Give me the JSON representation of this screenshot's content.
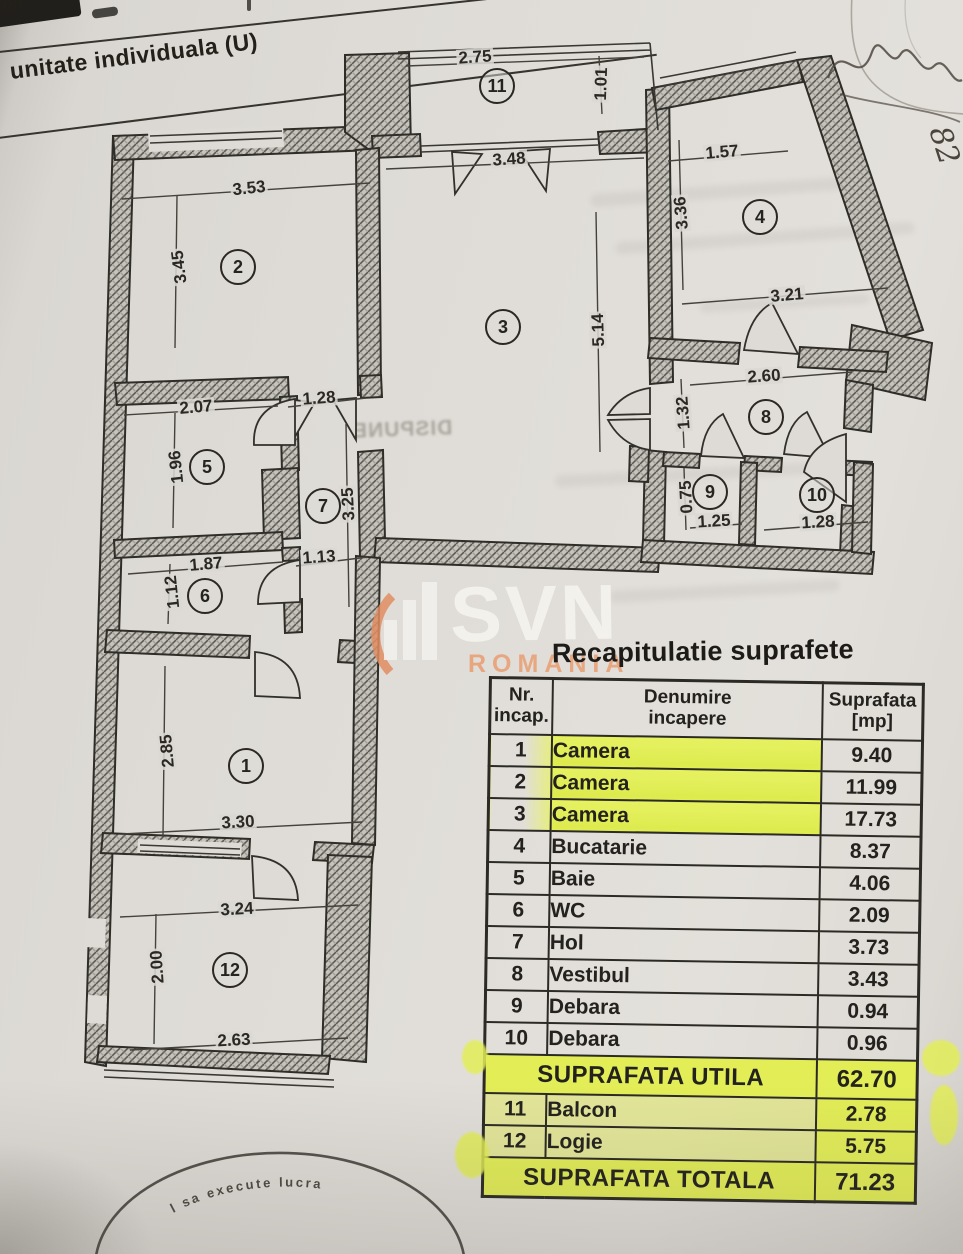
{
  "page": {
    "top_left_fragment": "tea",
    "top_left_title": "unitate individuala (U)",
    "handwritten_note": "82",
    "stamp_arc_text": "l sa execute lucra",
    "bleed_text": "DISPUNE"
  },
  "watermark": {
    "brand": "SVN",
    "region": "ROMANIA",
    "accent_orange": "#e08d62",
    "letter_color": "#f3f1ed"
  },
  "plan": {
    "rooms": [
      {
        "num": "1"
      },
      {
        "num": "2"
      },
      {
        "num": "3"
      },
      {
        "num": "4"
      },
      {
        "num": "5"
      },
      {
        "num": "6"
      },
      {
        "num": "7"
      },
      {
        "num": "8"
      },
      {
        "num": "9"
      },
      {
        "num": "10"
      },
      {
        "num": "11"
      },
      {
        "num": "12"
      }
    ],
    "dimensions": [
      {
        "value": "2.75",
        "orient": "h"
      },
      {
        "value": "1.01",
        "orient": "v"
      },
      {
        "value": "3.48",
        "orient": "h"
      },
      {
        "value": "1.57",
        "orient": "h"
      },
      {
        "value": "3.36",
        "orient": "v"
      },
      {
        "value": "3.53",
        "orient": "h"
      },
      {
        "value": "3.45",
        "orient": "v"
      },
      {
        "value": "3.21",
        "orient": "h"
      },
      {
        "value": "5.14",
        "orient": "v"
      },
      {
        "value": "2.60",
        "orient": "h"
      },
      {
        "value": "1.32",
        "orient": "v"
      },
      {
        "value": "2.07",
        "orient": "h"
      },
      {
        "value": "1.28",
        "orient": "h"
      },
      {
        "value": "1.96",
        "orient": "v"
      },
      {
        "value": "3.25",
        "orient": "v"
      },
      {
        "value": "0.75",
        "orient": "v"
      },
      {
        "value": "1.25",
        "orient": "h"
      },
      {
        "value": "1.28",
        "orient": "h"
      },
      {
        "value": "1.87",
        "orient": "h"
      },
      {
        "value": "1.13",
        "orient": "h"
      },
      {
        "value": "1.12",
        "orient": "v"
      },
      {
        "value": "2.85",
        "orient": "v"
      },
      {
        "value": "3.30",
        "orient": "h"
      },
      {
        "value": "3.24",
        "orient": "h"
      },
      {
        "value": "2.00",
        "orient": "v"
      },
      {
        "value": "2.63",
        "orient": "h"
      }
    ]
  },
  "table": {
    "title": "Recapitulatie suprafete",
    "highlight_color": "#e3ee57",
    "columns": [
      {
        "line1": "Nr.",
        "line2": "incap."
      },
      {
        "line1": "Denumire",
        "line2": "incapere"
      },
      {
        "line1": "Suprafata",
        "line2": "[mp]"
      }
    ],
    "rows": [
      {
        "type": "room",
        "nr": "1",
        "name": "Camera",
        "value": "9.40",
        "highlight": "name"
      },
      {
        "type": "room",
        "nr": "2",
        "name": "Camera",
        "value": "11.99",
        "highlight": "name"
      },
      {
        "type": "room",
        "nr": "3",
        "name": "Camera",
        "value": "17.73",
        "highlight": "name"
      },
      {
        "type": "room",
        "nr": "4",
        "name": "Bucatarie",
        "value": "8.37",
        "highlight": "none"
      },
      {
        "type": "room",
        "nr": "5",
        "name": "Baie",
        "value": "4.06",
        "highlight": "none"
      },
      {
        "type": "room",
        "nr": "6",
        "name": "WC",
        "value": "2.09",
        "highlight": "none"
      },
      {
        "type": "room",
        "nr": "7",
        "name": "Hol",
        "value": "3.73",
        "highlight": "none"
      },
      {
        "type": "room",
        "nr": "8",
        "name": "Vestibul",
        "value": "3.43",
        "highlight": "none"
      },
      {
        "type": "room",
        "nr": "9",
        "name": "Debara",
        "value": "0.94",
        "highlight": "none"
      },
      {
        "type": "room",
        "nr": "10",
        "name": "Debara",
        "value": "0.96",
        "highlight": "none"
      },
      {
        "type": "summary",
        "name": "SUPRAFATA UTILA",
        "value": "62.70",
        "highlight": "row"
      },
      {
        "type": "room",
        "nr": "11",
        "name": "Balcon",
        "value": "2.78",
        "highlight": "row-light"
      },
      {
        "type": "room",
        "nr": "12",
        "name": "Logie",
        "value": "5.75",
        "highlight": "row-light"
      },
      {
        "type": "summary",
        "name": "SUPRAFATA TOTALA",
        "value": "71.23",
        "highlight": "row"
      }
    ]
  }
}
